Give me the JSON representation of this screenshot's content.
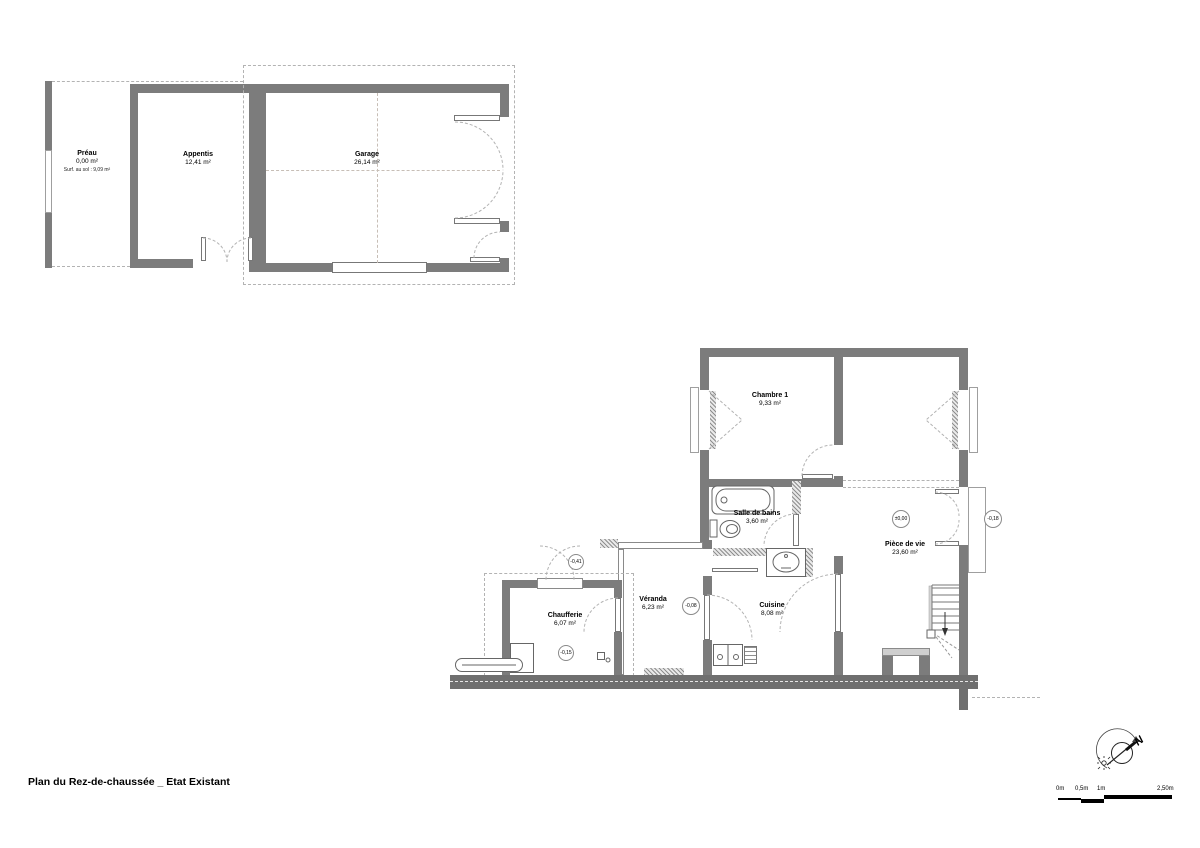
{
  "title": "Plan du Rez-de-chaussée _ Etat Existant",
  "rooms": {
    "preau": {
      "name": "Préau",
      "area": "0,00 m²",
      "note": "Surf. au sol : 9,09 m²"
    },
    "appentis": {
      "name": "Appentis",
      "area": "12,41 m²"
    },
    "garage": {
      "name": "Garage",
      "area": "26,14 m²"
    },
    "chambre1": {
      "name": "Chambre 1",
      "area": "9,33 m²"
    },
    "salle_de_bains": {
      "name": "Salle de bains",
      "area": "3,60 m²"
    },
    "piece_de_vie": {
      "name": "Pièce de vie",
      "area": "23,60 m²"
    },
    "veranda": {
      "name": "Véranda",
      "area": "6,23 m²"
    },
    "cuisine": {
      "name": "Cuisine",
      "area": "8,08 m²"
    },
    "chaufferie": {
      "name": "Chaufferie",
      "area": "6,07 m²"
    }
  },
  "levels": {
    "piece_de_vie": "±0,00",
    "exterior_east": "-0,18",
    "veranda": "-0,08",
    "chaufferie": "-0,15",
    "chaufferie_exterior": "-0,41"
  },
  "compass": {
    "north": "N"
  },
  "scale_bar": {
    "labels": [
      "0m",
      "0,5m",
      "1m",
      "2,50m"
    ]
  },
  "colors": {
    "wall": "#7c7c7c",
    "dash": "#b3b3b3",
    "line": "#666666"
  }
}
